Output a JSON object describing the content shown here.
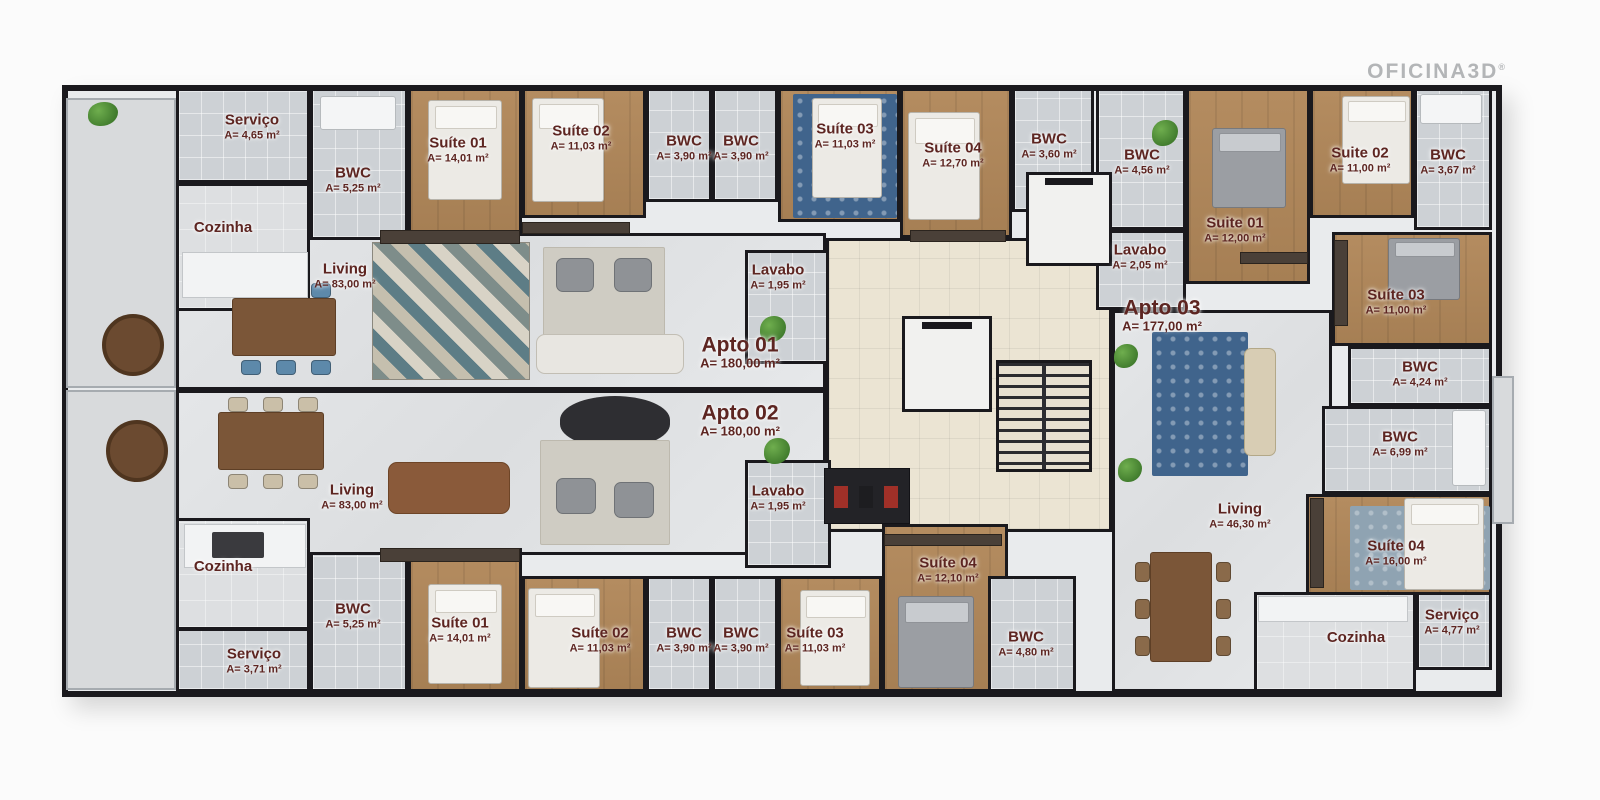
{
  "logo": {
    "text": "OFICINA3D",
    "registered": "®"
  },
  "colors": {
    "wall": "#1a191d",
    "label_text": "#5d2521",
    "wood_floor": "#ab865c",
    "tile_floor": "#cdd1d5",
    "marble_floor": "#e0e2e4",
    "core_floor": "#ebe4d3",
    "rug_blue": "#40648c",
    "locker_red": "#a03028",
    "logo_gray": "#b3b5b7"
  },
  "plan": {
    "canvas": {
      "w": 1600,
      "h": 800
    },
    "outline": [
      62,
      85,
      1440,
      612
    ],
    "apartment_labels": [
      {
        "id": "apto-01",
        "label": "Apto 01",
        "area": "A= 180,00 m²",
        "lx": 740,
        "ly": 352
      },
      {
        "id": "apto-02",
        "label": "Apto 02",
        "area": "A= 180,00 m²",
        "lx": 740,
        "ly": 420
      },
      {
        "id": "apto-03",
        "label": "Apto 03",
        "area": "A= 177,00 m²",
        "lx": 1162,
        "ly": 315
      }
    ],
    "areas": [
      {
        "id": "terrace-top",
        "rect": [
          66,
          98,
          110,
          290
        ],
        "floor": "terrace"
      },
      {
        "id": "terrace-bottom",
        "rect": [
          66,
          390,
          110,
          300
        ],
        "floor": "terrace"
      },
      {
        "id": "living-apto01",
        "rect": [
          176,
          233,
          650,
          157
        ],
        "floor": "marble",
        "label": "Living",
        "area": "A= 83,00 m²",
        "lx": 345,
        "ly": 276
      },
      {
        "id": "living-apto02",
        "rect": [
          176,
          390,
          650,
          165
        ],
        "floor": "marble",
        "label": "Living",
        "area": "A= 83,00 m²",
        "lx": 352,
        "ly": 497
      },
      {
        "id": "cozinha-apto01",
        "rect": [
          176,
          183,
          134,
          128
        ],
        "floor": "kitchen",
        "label": "Cozinha",
        "lx": 223,
        "ly": 228
      },
      {
        "id": "servico-apto01",
        "rect": [
          176,
          88,
          134,
          95
        ],
        "floor": "tile",
        "label": "Serviço",
        "area": "A= 4,65 m²",
        "lx": 252,
        "ly": 127
      },
      {
        "id": "bwc-suite01-apto01",
        "rect": [
          310,
          88,
          98,
          152
        ],
        "floor": "tile",
        "label": "BWC",
        "area": "A= 5,25 m²",
        "lx": 353,
        "ly": 180
      },
      {
        "id": "suite01-apto01",
        "rect": [
          408,
          88,
          114,
          146
        ],
        "floor": "wood",
        "label": "Suíte 01",
        "area": "A= 14,01 m²",
        "lx": 458,
        "ly": 150
      },
      {
        "id": "suite02-apto01",
        "rect": [
          522,
          88,
          124,
          130
        ],
        "floor": "wood",
        "label": "Suíte 02",
        "area": "A= 11,03 m²",
        "lx": 581,
        "ly": 138
      },
      {
        "id": "bwc-a-apto01",
        "rect": [
          646,
          88,
          66,
          114
        ],
        "floor": "tile",
        "label": "BWC",
        "area": "A= 3,90 m²",
        "lx": 684,
        "ly": 148
      },
      {
        "id": "bwc-b-apto01",
        "rect": [
          712,
          88,
          66,
          114
        ],
        "floor": "tile",
        "label": "BWC",
        "area": "A= 3,90 m²",
        "lx": 741,
        "ly": 148
      },
      {
        "id": "suite03-apto01",
        "rect": [
          778,
          88,
          122,
          134
        ],
        "floor": "wood",
        "label": "Suíte 03",
        "area": "A= 11,03 m²",
        "lx": 845,
        "ly": 136
      },
      {
        "id": "suite04-apto01",
        "rect": [
          900,
          88,
          112,
          150
        ],
        "floor": "wood",
        "label": "Suíte 04",
        "area": "A= 12,70 m²",
        "lx": 953,
        "ly": 155
      },
      {
        "id": "bwc-suite04-apto01",
        "rect": [
          1012,
          88,
          82,
          124
        ],
        "floor": "tile",
        "label": "BWC",
        "area": "A= 3,60 m²",
        "lx": 1049,
        "ly": 146
      },
      {
        "id": "lavabo-apto01",
        "rect": [
          745,
          250,
          86,
          114
        ],
        "floor": "tile",
        "label": "Lavabo",
        "area": "A= 1,95 m²",
        "lx": 778,
        "ly": 277
      },
      {
        "id": "core-hall",
        "rect": [
          826,
          238,
          286,
          294
        ],
        "floor": "core"
      },
      {
        "id": "lavabo-apto02",
        "rect": [
          745,
          460,
          86,
          108
        ],
        "floor": "tile",
        "label": "Lavabo",
        "area": "A= 1,95 m²",
        "lx": 778,
        "ly": 498
      },
      {
        "id": "cozinha-apto02",
        "rect": [
          176,
          518,
          134,
          112
        ],
        "floor": "kitchen",
        "label": "Cozinha",
        "lx": 223,
        "ly": 567
      },
      {
        "id": "servico-apto02",
        "rect": [
          176,
          628,
          134,
          64
        ],
        "floor": "tile",
        "label": "Serviço",
        "area": "A= 3,71 m²",
        "lx": 254,
        "ly": 661
      },
      {
        "id": "bwc-suite01-apto02",
        "rect": [
          310,
          552,
          98,
          140
        ],
        "floor": "tile",
        "label": "BWC",
        "area": "A= 5,25 m²",
        "lx": 353,
        "ly": 616
      },
      {
        "id": "suite01-apto02",
        "rect": [
          408,
          548,
          114,
          144
        ],
        "floor": "wood",
        "label": "Suíte 01",
        "area": "A= 14,01 m²",
        "lx": 460,
        "ly": 630
      },
      {
        "id": "suite02-apto02",
        "rect": [
          522,
          576,
          124,
          116
        ],
        "floor": "wood",
        "label": "Suíte 02",
        "area": "A= 11,03 m²",
        "lx": 600,
        "ly": 640
      },
      {
        "id": "bwc-a-apto02",
        "rect": [
          646,
          576,
          66,
          116
        ],
        "floor": "tile",
        "label": "BWC",
        "area": "A= 3,90 m²",
        "lx": 684,
        "ly": 640
      },
      {
        "id": "bwc-b-apto02",
        "rect": [
          712,
          576,
          66,
          116
        ],
        "floor": "tile",
        "label": "BWC",
        "area": "A= 3,90 m²",
        "lx": 741,
        "ly": 640
      },
      {
        "id": "suite03-apto02",
        "rect": [
          778,
          576,
          104,
          116
        ],
        "floor": "wood",
        "label": "Suíte 03",
        "area": "A= 11,03 m²",
        "lx": 815,
        "ly": 640
      },
      {
        "id": "suite04-apto02",
        "rect": [
          882,
          524,
          126,
          168
        ],
        "floor": "wood",
        "label": "Suíte 04",
        "area": "A= 12,10 m²",
        "lx": 948,
        "ly": 570
      },
      {
        "id": "bwc-suite04-apto02",
        "rect": [
          988,
          576,
          88,
          116
        ],
        "floor": "tile",
        "label": "BWC",
        "area": "A= 4,80 m²",
        "lx": 1026,
        "ly": 644
      },
      {
        "id": "bwc-456-apto03",
        "rect": [
          1096,
          88,
          90,
          142
        ],
        "floor": "tile",
        "label": "BWC",
        "area": "A= 4,56 m²",
        "lx": 1142,
        "ly": 162
      },
      {
        "id": "lavabo-apto03",
        "rect": [
          1096,
          230,
          90,
          80
        ],
        "floor": "tile",
        "label": "Lavabo",
        "area": "A= 2,05 m²",
        "lx": 1140,
        "ly": 257
      },
      {
        "id": "suite01-apto03",
        "rect": [
          1186,
          88,
          124,
          196
        ],
        "floor": "wood",
        "label": "Suite 01",
        "area": "A= 12,00 m²",
        "lx": 1235,
        "ly": 230
      },
      {
        "id": "suite02-apto03",
        "rect": [
          1310,
          88,
          104,
          130
        ],
        "floor": "wood",
        "label": "Suite 02",
        "area": "A= 11,00 m²",
        "lx": 1360,
        "ly": 160
      },
      {
        "id": "bwc-suite02-apto03",
        "rect": [
          1414,
          88,
          78,
          142
        ],
        "floor": "tile",
        "label": "BWC",
        "area": "A= 3,67 m²",
        "lx": 1448,
        "ly": 162
      },
      {
        "id": "living-apto03",
        "rect": [
          1112,
          310,
          220,
          382
        ],
        "floor": "marble",
        "label": "Living",
        "area": "A= 46,30 m²",
        "lx": 1240,
        "ly": 516
      },
      {
        "id": "suite03-apto03",
        "rect": [
          1332,
          232,
          160,
          114
        ],
        "floor": "wood",
        "label": "Suíte 03",
        "area": "A= 11,00 m²",
        "lx": 1396,
        "ly": 302
      },
      {
        "id": "bwc-424-apto03",
        "rect": [
          1348,
          346,
          144,
          60
        ],
        "floor": "tile",
        "label": "BWC",
        "area": "A= 4,24 m²",
        "lx": 1420,
        "ly": 374
      },
      {
        "id": "bwc-699-apto03",
        "rect": [
          1322,
          406,
          170,
          88
        ],
        "floor": "tile",
        "label": "BWC",
        "area": "A= 6,99 m²",
        "lx": 1400,
        "ly": 444
      },
      {
        "id": "suite04-apto03",
        "rect": [
          1306,
          494,
          186,
          102
        ],
        "floor": "wood",
        "label": "Suíte 04",
        "area": "A= 16,00 m²",
        "lx": 1396,
        "ly": 553
      },
      {
        "id": "cozinha-apto03",
        "rect": [
          1254,
          592,
          162,
          100
        ],
        "floor": "kitchen",
        "label": "Cozinha",
        "lx": 1356,
        "ly": 638
      },
      {
        "id": "servico-apto03",
        "rect": [
          1416,
          592,
          76,
          78
        ],
        "floor": "tile",
        "label": "Serviço",
        "area": "A= 4,77 m²",
        "lx": 1452,
        "ly": 622
      },
      {
        "id": "balcony-right",
        "rect": [
          1492,
          376,
          22,
          148
        ],
        "floor": "terrace"
      }
    ],
    "furniture": [
      {
        "type": "rug-chevron",
        "rect": [
          372,
          242,
          158,
          138
        ],
        "name": "chevron-rug"
      },
      {
        "type": "rug-plain",
        "rect": [
          543,
          247,
          122,
          110
        ],
        "name": "area-rug"
      },
      {
        "type": "armchair",
        "rect": [
          556,
          258,
          38,
          34
        ],
        "name": "armchair"
      },
      {
        "type": "armchair",
        "rect": [
          614,
          258,
          38,
          34
        ],
        "name": "armchair"
      },
      {
        "type": "sofa",
        "rect": [
          536,
          334,
          148,
          40
        ],
        "name": "sofa"
      },
      {
        "type": "oval-dark",
        "rect": [
          560,
          396,
          110,
          52
        ],
        "name": "oval-sofa"
      },
      {
        "type": "rug-plain",
        "rect": [
          540,
          440,
          130,
          105
        ],
        "name": "area-rug"
      },
      {
        "type": "armchair",
        "rect": [
          556,
          478,
          40,
          36
        ],
        "name": "armchair"
      },
      {
        "type": "armchair",
        "rect": [
          614,
          482,
          40,
          36
        ],
        "name": "armchair"
      },
      {
        "type": "sofa-brown",
        "rect": [
          388,
          462,
          122,
          52
        ],
        "name": "sofa"
      },
      {
        "type": "dining",
        "rect": [
          232,
          298,
          104,
          58
        ],
        "chairs": "#5d89aa",
        "orient": "h",
        "name": "dining-set"
      },
      {
        "type": "dining",
        "rect": [
          218,
          412,
          106,
          58
        ],
        "chairs": "#cabfa8",
        "orient": "h",
        "name": "dining-set"
      },
      {
        "type": "dining",
        "rect": [
          1150,
          552,
          62,
          110
        ],
        "chairs": "#8a6a4a",
        "orient": "v",
        "name": "dining-set"
      },
      {
        "type": "round-table",
        "rect": [
          102,
          314,
          62,
          62
        ],
        "name": "round-table"
      },
      {
        "type": "round-table",
        "rect": [
          106,
          420,
          62,
          62
        ],
        "name": "round-table"
      },
      {
        "type": "counter",
        "rect": [
          182,
          252,
          126,
          46
        ],
        "name": "kitchen-island"
      },
      {
        "type": "counter",
        "rect": [
          184,
          524,
          122,
          44
        ],
        "name": "kitchen-island"
      },
      {
        "type": "stove",
        "rect": [
          212,
          532,
          52,
          26
        ],
        "name": "cooktop"
      },
      {
        "type": "counter",
        "rect": [
          1258,
          596,
          150,
          26
        ],
        "name": "kitchen-counter"
      },
      {
        "type": "bed",
        "rect": [
          428,
          100,
          74,
          100
        ],
        "name": "bed"
      },
      {
        "type": "bed",
        "rect": [
          532,
          98,
          72,
          104
        ],
        "name": "bed"
      },
      {
        "type": "rug-blue",
        "rect": [
          793,
          94,
          104,
          124
        ],
        "name": "patterned-rug"
      },
      {
        "type": "bed",
        "rect": [
          812,
          98,
          70,
          100
        ],
        "name": "bed"
      },
      {
        "type": "bed",
        "rect": [
          908,
          112,
          72,
          108
        ],
        "name": "bed"
      },
      {
        "type": "bed",
        "rect": [
          428,
          584,
          74,
          100
        ],
        "name": "bed"
      },
      {
        "type": "bed",
        "rect": [
          528,
          588,
          72,
          100
        ],
        "name": "bed"
      },
      {
        "type": "bed",
        "rect": [
          800,
          590,
          70,
          96
        ],
        "name": "bed"
      },
      {
        "type": "bed-gray",
        "rect": [
          898,
          596,
          76,
          92
        ],
        "name": "bed"
      },
      {
        "type": "bed-gray",
        "rect": [
          1212,
          128,
          74,
          80
        ],
        "name": "bed"
      },
      {
        "type": "bed",
        "rect": [
          1342,
          96,
          68,
          88
        ],
        "name": "bed"
      },
      {
        "type": "bed-gray",
        "rect": [
          1388,
          238,
          72,
          62
        ],
        "name": "bed"
      },
      {
        "type": "rug-gray",
        "rect": [
          1350,
          506,
          140,
          84
        ],
        "name": "rug"
      },
      {
        "type": "bed",
        "rect": [
          1404,
          498,
          80,
          92
        ],
        "name": "bed"
      },
      {
        "type": "rug-blue",
        "rect": [
          1152,
          332,
          96,
          144
        ],
        "name": "patterned-rug"
      },
      {
        "type": "sofa-v",
        "rect": [
          1244,
          348,
          32,
          108
        ],
        "name": "sofa"
      },
      {
        "type": "closet",
        "rect": [
          380,
          230,
          140,
          14
        ],
        "name": "wardrobe"
      },
      {
        "type": "closet",
        "rect": [
          522,
          222,
          108,
          12
        ],
        "name": "wardrobe"
      },
      {
        "type": "closet",
        "rect": [
          910,
          230,
          96,
          12
        ],
        "name": "wardrobe"
      },
      {
        "type": "closet",
        "rect": [
          380,
          548,
          140,
          14
        ],
        "name": "wardrobe"
      },
      {
        "type": "closet",
        "rect": [
          884,
          534,
          118,
          12
        ],
        "name": "wardrobe"
      },
      {
        "type": "closet",
        "rect": [
          1240,
          252,
          68,
          12
        ],
        "name": "sideboard"
      },
      {
        "type": "closet-v",
        "rect": [
          1334,
          240,
          14,
          86
        ],
        "name": "wardrobe"
      },
      {
        "type": "closet-v",
        "rect": [
          1310,
          498,
          14,
          90
        ],
        "name": "wardrobe"
      },
      {
        "type": "elevator",
        "rect": [
          1026,
          172,
          86,
          94
        ],
        "name": "elevator"
      },
      {
        "type": "elevator",
        "rect": [
          902,
          316,
          90,
          96
        ],
        "name": "elevator"
      },
      {
        "type": "stairs",
        "rect": [
          996,
          360,
          96,
          112
        ],
        "name": "stairs"
      },
      {
        "type": "lockers",
        "rect": [
          824,
          468,
          86,
          56
        ],
        "name": "utility-lockers"
      },
      {
        "type": "fixture",
        "rect": [
          320,
          96,
          76,
          34
        ],
        "name": "bathtub"
      },
      {
        "type": "fixture",
        "rect": [
          1420,
          94,
          62,
          30
        ],
        "name": "bathtub"
      },
      {
        "type": "fixture",
        "rect": [
          1452,
          410,
          34,
          76
        ],
        "name": "shower"
      },
      {
        "type": "plant",
        "rect": [
          88,
          102,
          30,
          24
        ],
        "name": "plant"
      },
      {
        "type": "plant",
        "rect": [
          760,
          316,
          26,
          26
        ],
        "name": "plant"
      },
      {
        "type": "plant",
        "rect": [
          764,
          438,
          26,
          26
        ],
        "name": "plant"
      },
      {
        "type": "plant",
        "rect": [
          1114,
          344,
          24,
          24
        ],
        "name": "plant"
      },
      {
        "type": "plant",
        "rect": [
          1118,
          458,
          24,
          24
        ],
        "name": "plant"
      },
      {
        "type": "plant",
        "rect": [
          1152,
          120,
          26,
          26
        ],
        "name": "plant"
      }
    ]
  }
}
